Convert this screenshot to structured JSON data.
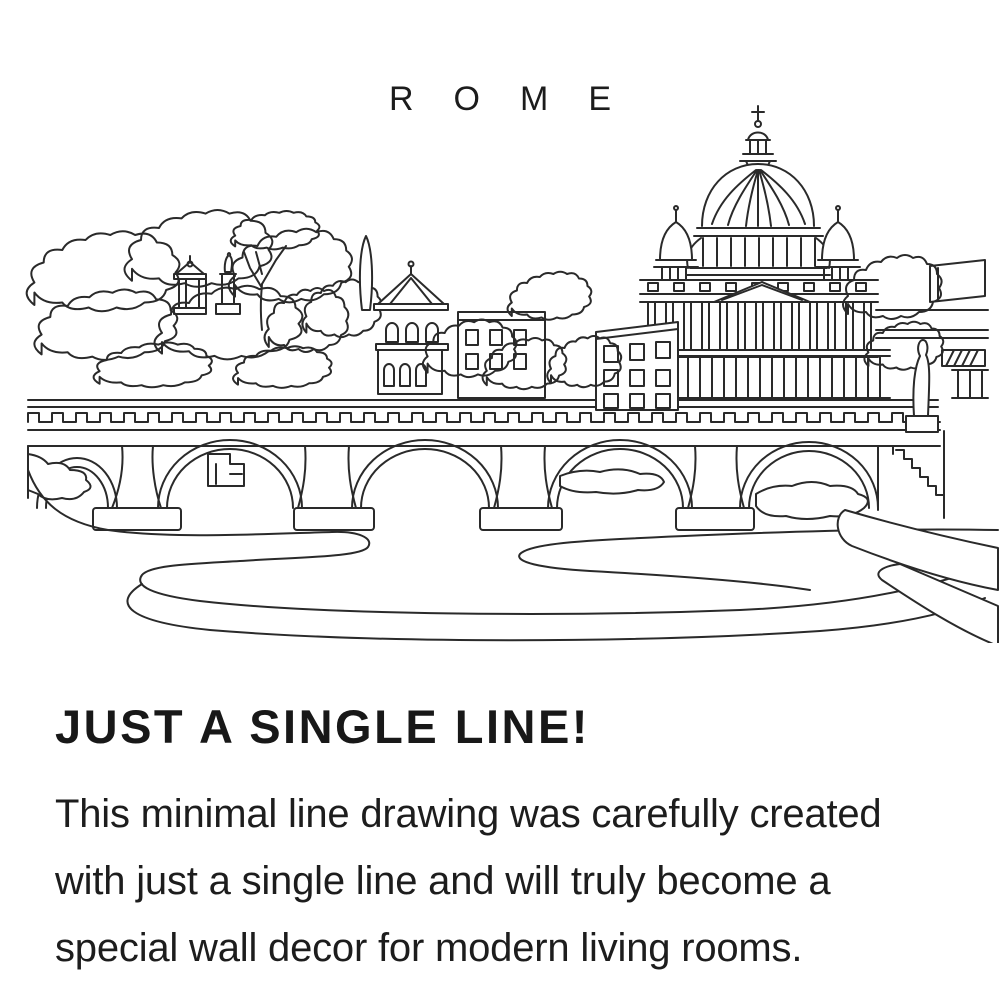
{
  "page": {
    "background_color": "#ffffff",
    "text_color": "#1d1d1d",
    "line_art_color": "#2a2a2a"
  },
  "header": {
    "title": "ROME"
  },
  "artwork": {
    "subject": "Rome skyline single line drawing - St. Peter's Basilica and bridge over the Tiber river"
  },
  "heading": {
    "text": "JUST A SINGLE LINE!"
  },
  "paragraph": {
    "lines": [
      "This minimal line drawing was carefully created",
      "with just a single line and will truly become a",
      "special wall decor for modern living rooms."
    ]
  }
}
